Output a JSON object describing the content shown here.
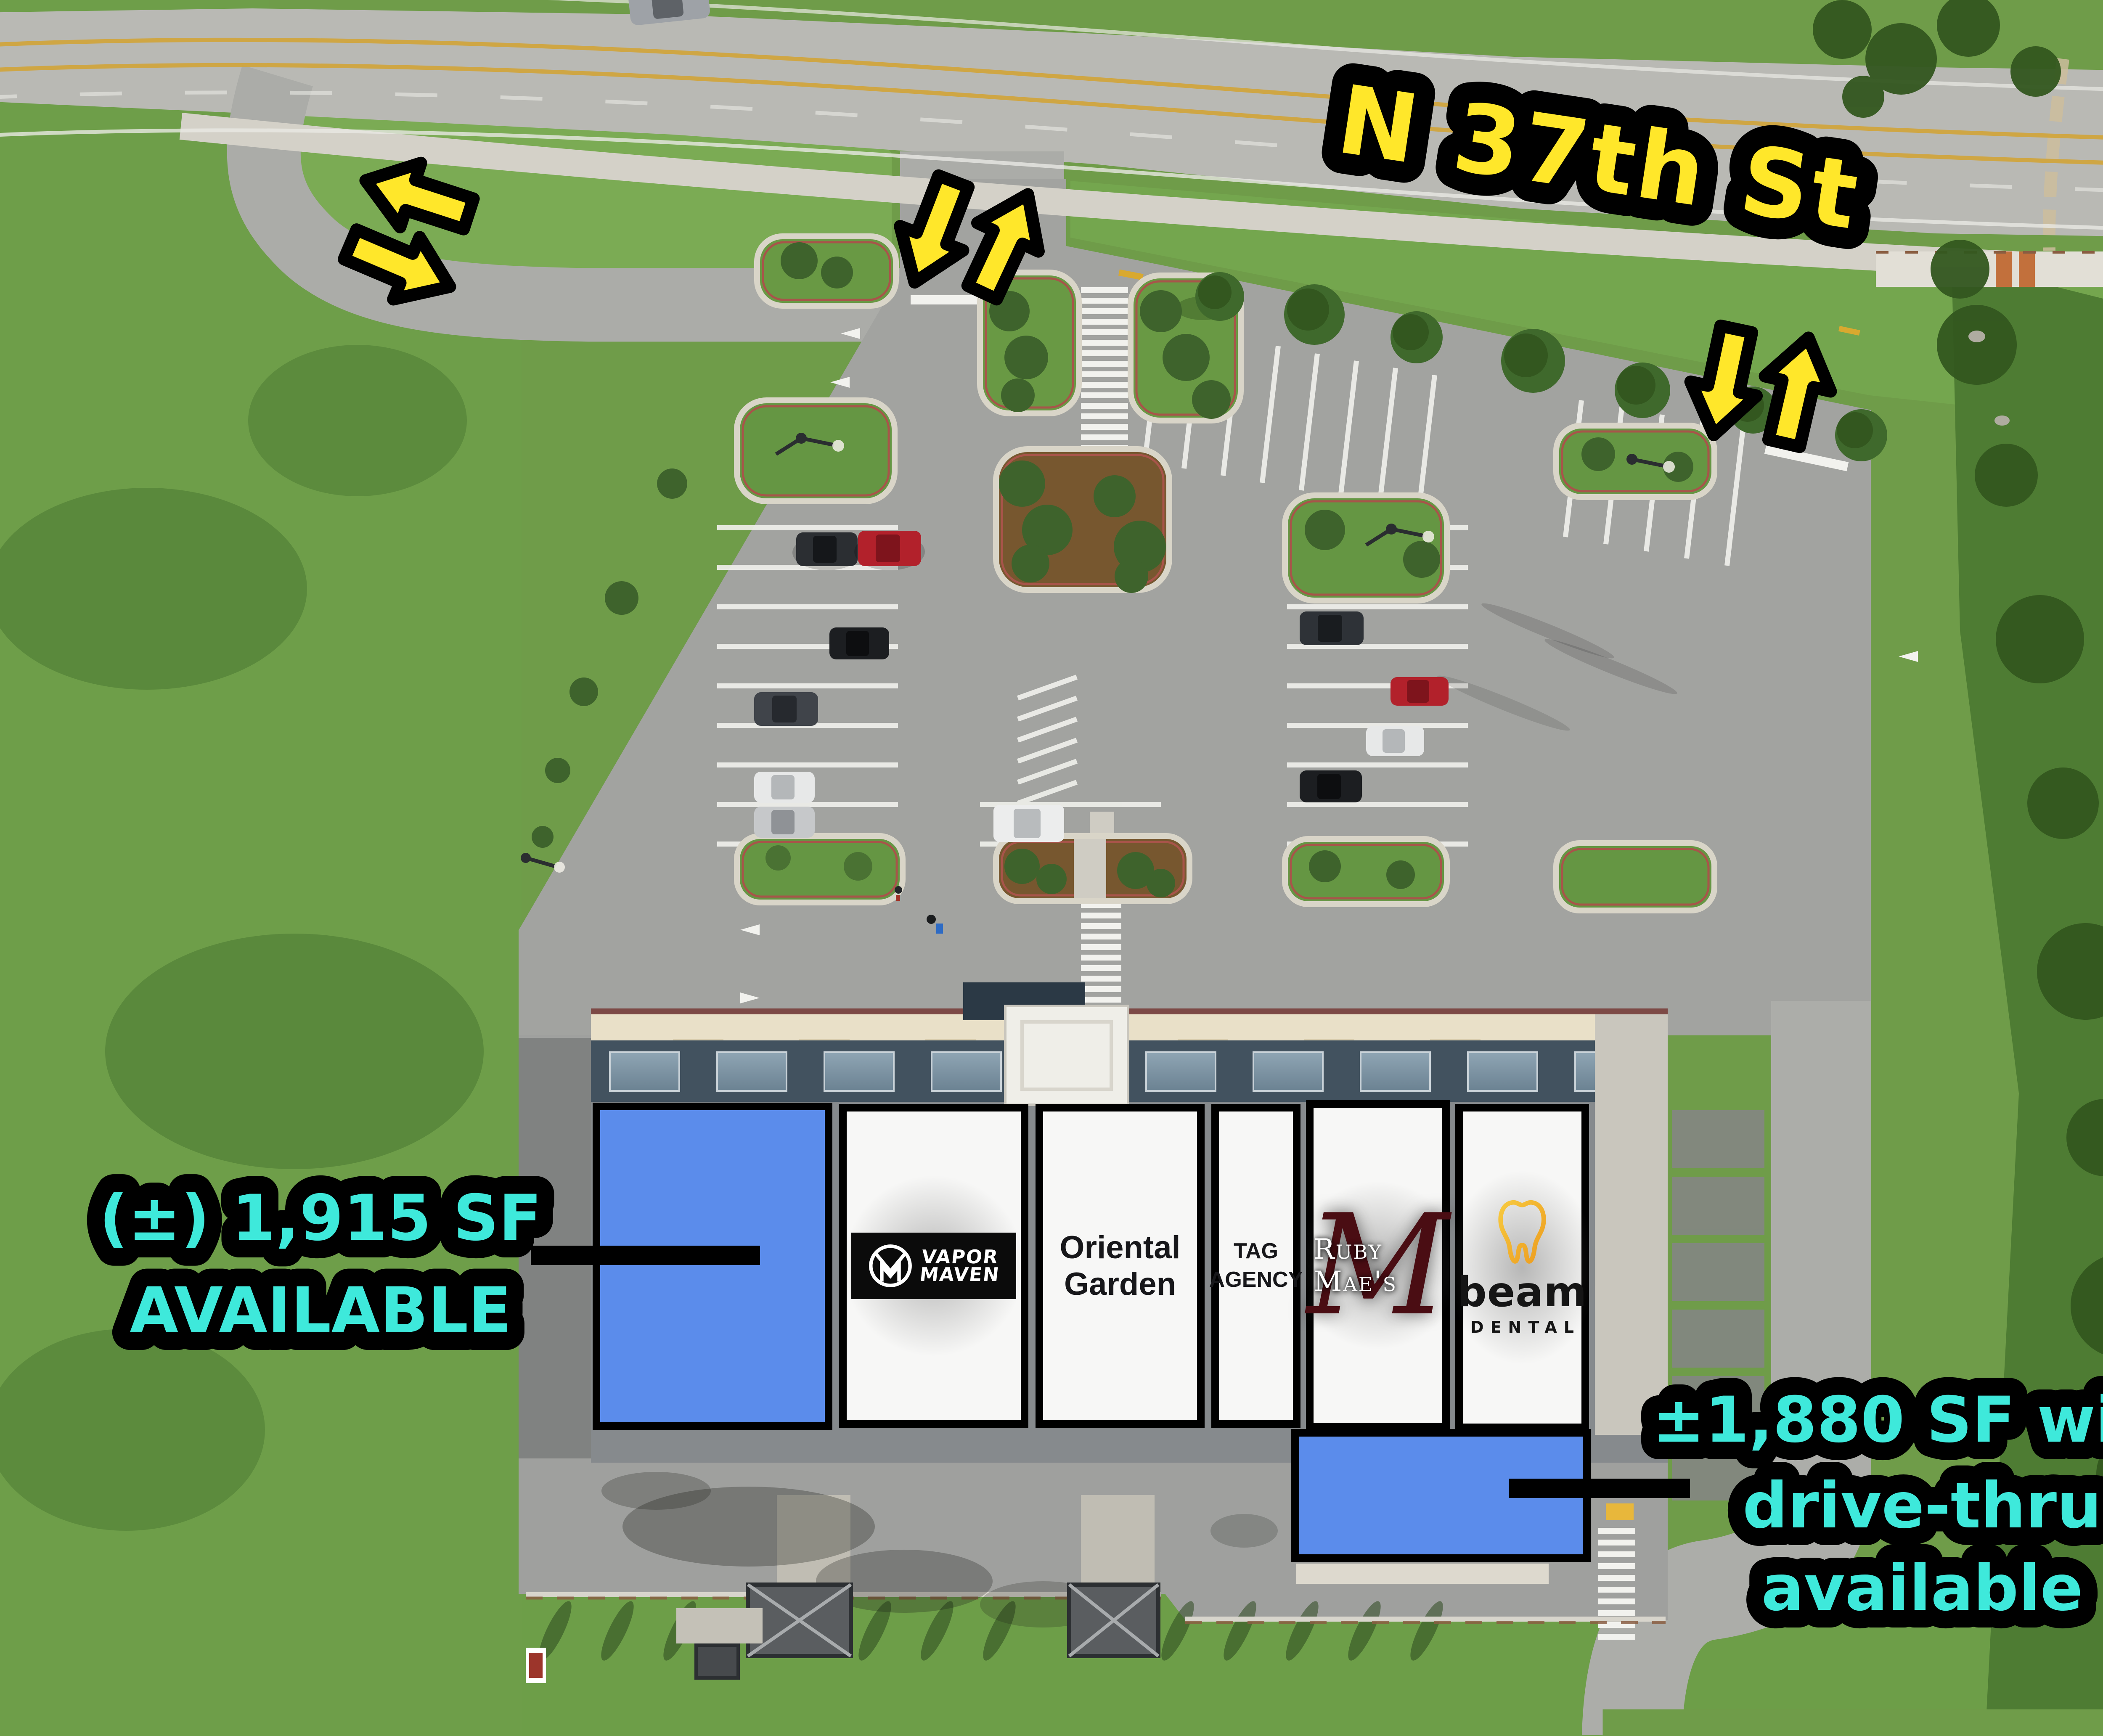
{
  "photo": {
    "street_label": "N 37th St"
  },
  "annotations": {
    "left_availability": {
      "line1": "(±) 1,915 SF",
      "line2": "AVAILABLE"
    },
    "right_availability": {
      "line1": "±1,880 SF with",
      "line2": "drive-thru",
      "line3": "available"
    }
  },
  "tenants": {
    "vapor": {
      "line1": "VAPOR",
      "line2": "MAVEN"
    },
    "oriental": {
      "line1": "Oriental",
      "line2": "Garden"
    },
    "tag": {
      "line1": "TAG",
      "line2": "AGENCY"
    },
    "ruby": {
      "monogram": "M",
      "label": "Ruby Mae's"
    },
    "beam": {
      "line1": "beam",
      "line2": "DENTAL"
    }
  },
  "colors": {
    "highlight_yellow": "#FFE72A",
    "highlight_cyan": "#3EE9DB",
    "available_blue": "#5B8CEB"
  }
}
